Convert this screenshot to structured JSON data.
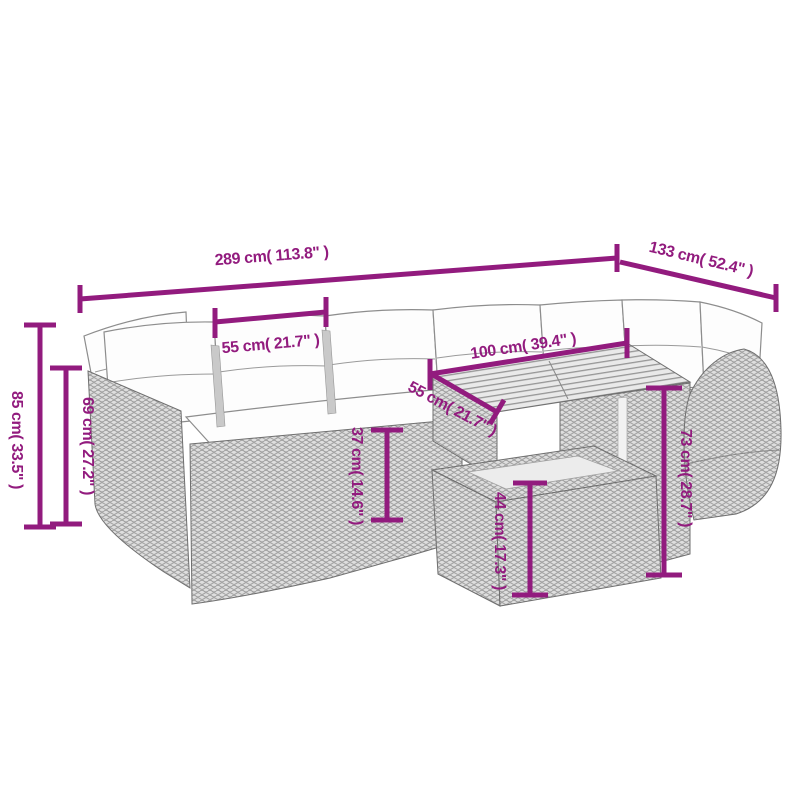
{
  "colors": {
    "annotation_magenta": "#921b7e",
    "line_art_gray": "#8d8d8d",
    "background": "#ffffff"
  },
  "dimensions": [
    {
      "id": "overall-width",
      "label": "289 cm( 113.8\" )"
    },
    {
      "id": "overall-depth",
      "label": "133 cm( 52.4\" )"
    },
    {
      "id": "backrest-width",
      "label": "55 cm( 21.7\" )"
    },
    {
      "id": "table-length",
      "label": "100 cm( 39.4\" )"
    },
    {
      "id": "table-depth",
      "label": "55 cm( 21.7\" )"
    },
    {
      "id": "overall-height",
      "label": "85 cm( 33.5\" )"
    },
    {
      "id": "back-height",
      "label": "69 cm( 27.2\" )"
    },
    {
      "id": "seat-height",
      "label": "37 cm( 14.6\" )"
    },
    {
      "id": "ottoman-height",
      "label": "44 cm( 17.3\" )"
    },
    {
      "id": "table-height",
      "label": "73 cm( 28.7\" )"
    }
  ]
}
